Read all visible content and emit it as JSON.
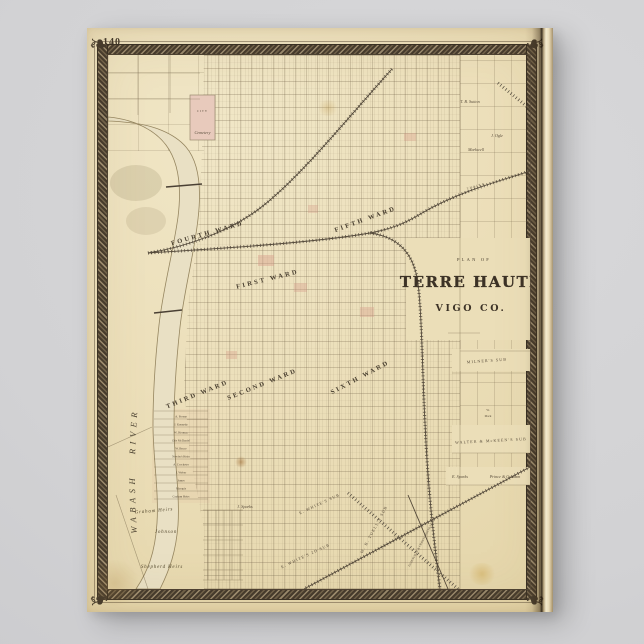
{
  "page": {
    "number": "140"
  },
  "title": {
    "kicker": "PLAN OF",
    "main": "TERRE HAUTE",
    "sub": "VIGO CO."
  },
  "river": {
    "label": "WABASH RIVER"
  },
  "wards": [
    "FOURTH WARD",
    "FIFTH WARD",
    "FIRST WARD",
    "THIRD WARD",
    "SECOND WARD",
    "SIXTH WARD"
  ],
  "subdivisions": {
    "cemetery_top": "CITY",
    "cemetery_bottom": "Cemetery",
    "milners": "MILNER'S SUB",
    "walter_mckeen": "WALTER & McKEEN'S SUB",
    "e_whites": "E. WHITE'S SUB",
    "e_whites_2d": "E. WHITE'S 2D SUB",
    "tuells": "W. B. TUELL'S SUB"
  },
  "railroads": {
    "northeast": "T. H. & I. R. R.",
    "south": "EVANSVILLE & CRAWFORDSVILLE R. R."
  },
  "landowners": {
    "west_bank": [
      "A. Fresne",
      "J. Kennedy",
      "W. Herman",
      "Otis McDaniel",
      "W. Bruce",
      "Newby's Heirs",
      "A. Crocketer",
      "J. Weber",
      "James",
      "Marquis",
      "Graham Heirs"
    ],
    "northeast": [
      "T. B. Sutton",
      "J. Ogle",
      "Markwell"
    ],
    "south": {
      "j_sparks": "J. Sparks",
      "johnson": "Johnson",
      "shepherd": "Shepherd Heirs",
      "graham": "Graham Heirs",
      "e_sparks": "E. Sparks",
      "prince_graham": "Prince & Graham",
      "w_mack_1": "W.",
      "w_mack_2": "Mack"
    }
  },
  "decorations": {
    "corner_glyph": "❧"
  },
  "colors": {
    "background": "#d2d2d4",
    "paper": "#ecdfba",
    "border": "#43392c",
    "ink": "#5a4e3c",
    "pink_wash": "#ddab9b",
    "river_fill": "#e9e0c4"
  }
}
